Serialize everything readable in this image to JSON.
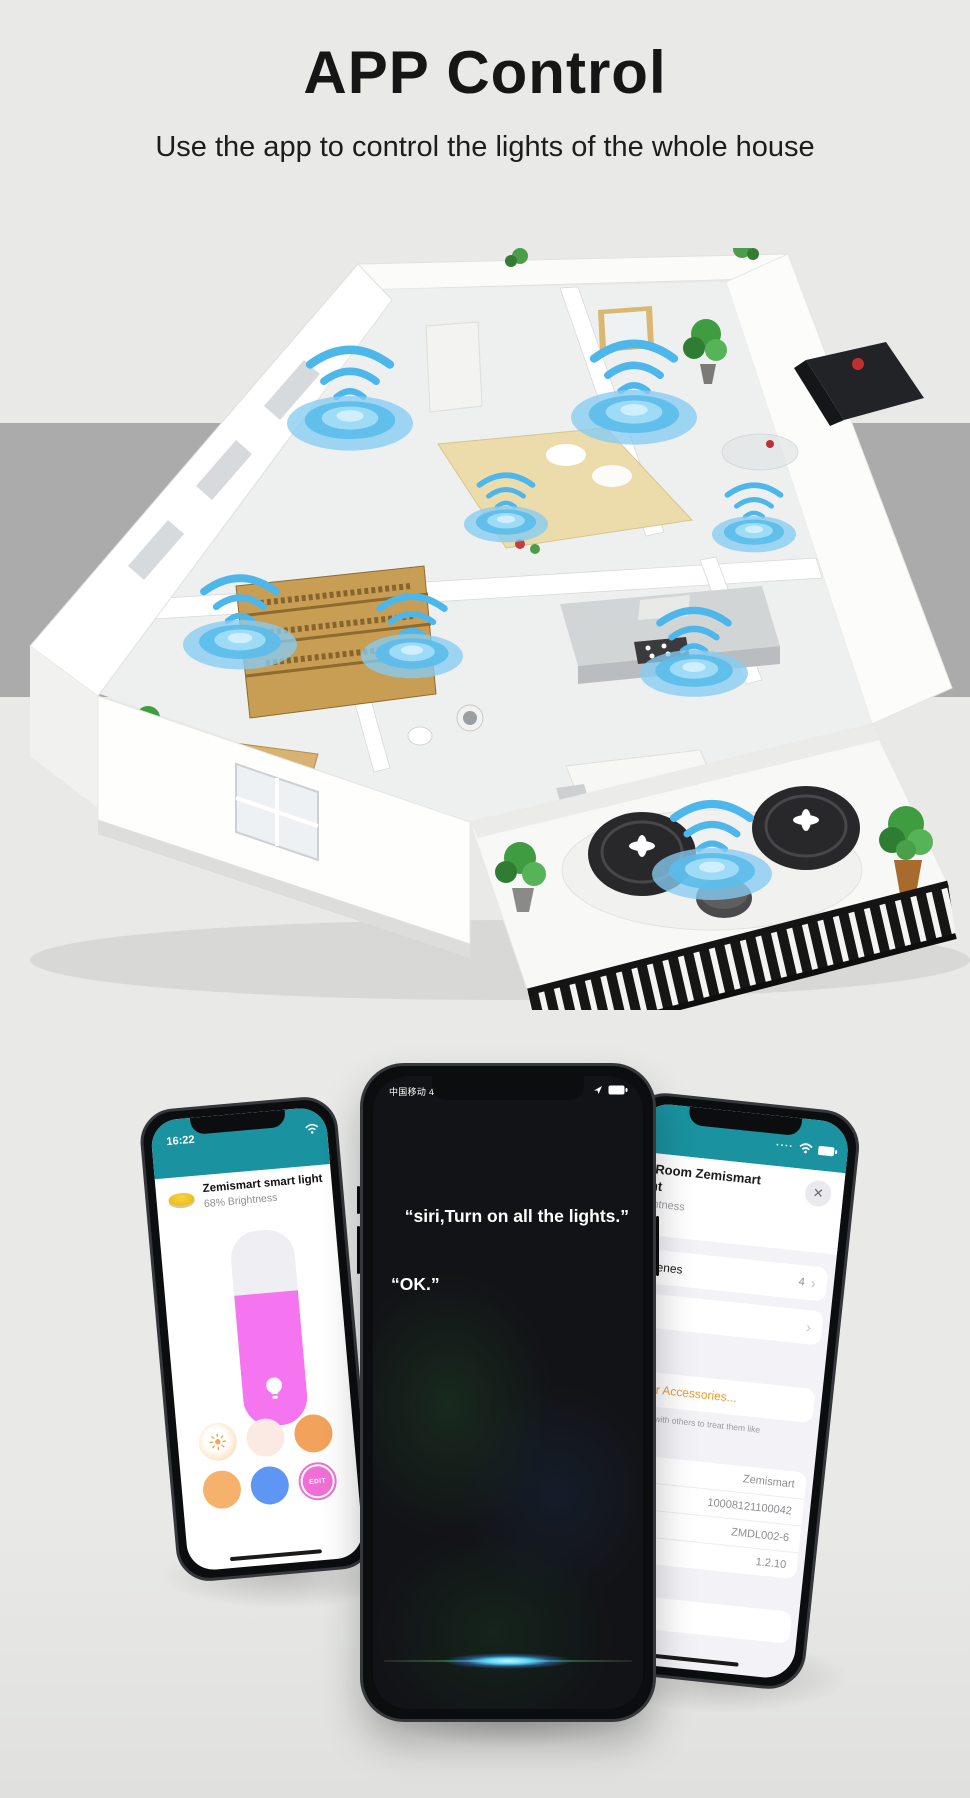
{
  "header": {
    "title": "APP Control",
    "subtitle": "Use the app to control the lights of the whole house"
  },
  "house": {
    "type": "isometric apartment floor plan render",
    "wifi_signal_count": 8
  },
  "left_phone": {
    "status_time": "16:22",
    "device_name": "Zemismart smart light",
    "brightness_text": "68% Brightness",
    "brightness_percent": 68,
    "edit_button_label": "EDIT",
    "swatches": [
      "warm-white-sun",
      "soft-pink",
      "orange",
      "light-orange",
      "blue",
      "edit"
    ]
  },
  "center_phone": {
    "carrier_network": "中国移动 4G",
    "siri_command": "“siri,Turn on all the lights.”",
    "siri_reply": "“OK.”"
  },
  "right_phone": {
    "title_fragment_line1": "g Room Zemismart",
    "title_fragment_line2": "ght",
    "subtitle_fragment": "rightness",
    "close_glyph": "✕",
    "scenes_label": "Scenes",
    "scenes_value": "4",
    "chevron_glyph": "›",
    "other_accessories_label": "Other Accessories...",
    "note_line1": "cessory with others to treat them like",
    "note_line2": "y.",
    "info_rows": [
      {
        "label": "rer",
        "value": "Zemismart"
      },
      {
        "label": "ber",
        "value": "10008121100042"
      },
      {
        "label": "",
        "value": "ZMDL002-6"
      },
      {
        "label": "",
        "value": "1.2.10"
      }
    ],
    "remove_accessory_fragment": "ccessory"
  },
  "colors": {
    "teal": "#1a92a0",
    "accent_orange": "#f49b2a",
    "wifi_blue": "#5bbceb",
    "band_gray": "#ababab",
    "slider_pink": "#f574ef"
  }
}
